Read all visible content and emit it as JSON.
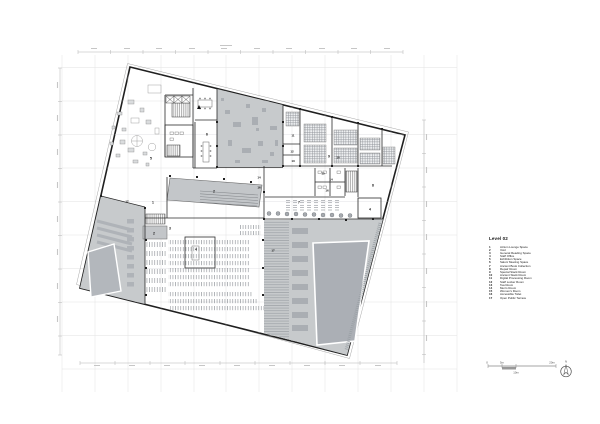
{
  "legend": {
    "title": "Level 02",
    "items": [
      {
        "num": "1",
        "label": "Atrium Lounge Space"
      },
      {
        "num": "2",
        "label": "Void"
      },
      {
        "num": "3",
        "label": "General Reading Space"
      },
      {
        "num": "4",
        "label": "Staff Office"
      },
      {
        "num": "5",
        "label": "Exhibition Space"
      },
      {
        "num": "6",
        "label": "Salon/ Meeting Space"
      },
      {
        "num": "7",
        "label": "Ancient Book Collection"
      },
      {
        "num": "8",
        "label": "Repair Room"
      },
      {
        "num": "9",
        "label": "Special Stack Room"
      },
      {
        "num": "10",
        "label": "Ancient Stack Room"
      },
      {
        "num": "11",
        "label": "Digital Processing Room"
      },
      {
        "num": "12",
        "label": "Staff Locker Room"
      },
      {
        "num": "13",
        "label": "Tea Room"
      },
      {
        "num": "14",
        "label": "Men's Room"
      },
      {
        "num": "15",
        "label": "Women's Room"
      },
      {
        "num": "16",
        "label": "Accessible Toilet"
      },
      {
        "num": "17",
        "label": "Open Public Terrace"
      }
    ]
  },
  "plan": {
    "labels": [
      {
        "t": "5"
      },
      {
        "t": "6"
      },
      {
        "t": "1"
      },
      {
        "t": "2"
      },
      {
        "t": "2"
      },
      {
        "t": "3"
      },
      {
        "t": "4"
      },
      {
        "t": "4"
      },
      {
        "t": "7"
      },
      {
        "t": "8"
      },
      {
        "t": "9"
      },
      {
        "t": "10"
      },
      {
        "t": "11"
      },
      {
        "t": "12"
      },
      {
        "t": "13"
      },
      {
        "t": "14"
      },
      {
        "t": "16"
      },
      {
        "t": "14"
      },
      {
        "t": "15"
      },
      {
        "t": "16"
      },
      {
        "t": "17"
      },
      {
        "t": "17"
      }
    ]
  },
  "scalebar": {
    "labels": [
      "0",
      "5m",
      "10m",
      "20m"
    ]
  },
  "north": {
    "label": "N"
  },
  "colors": {
    "terrace": "#c7cacc",
    "terrace_dark": "#abafb5",
    "void": "#c3c6c9",
    "wall": "#2b2b2b",
    "grid": "#e2e2e2"
  }
}
